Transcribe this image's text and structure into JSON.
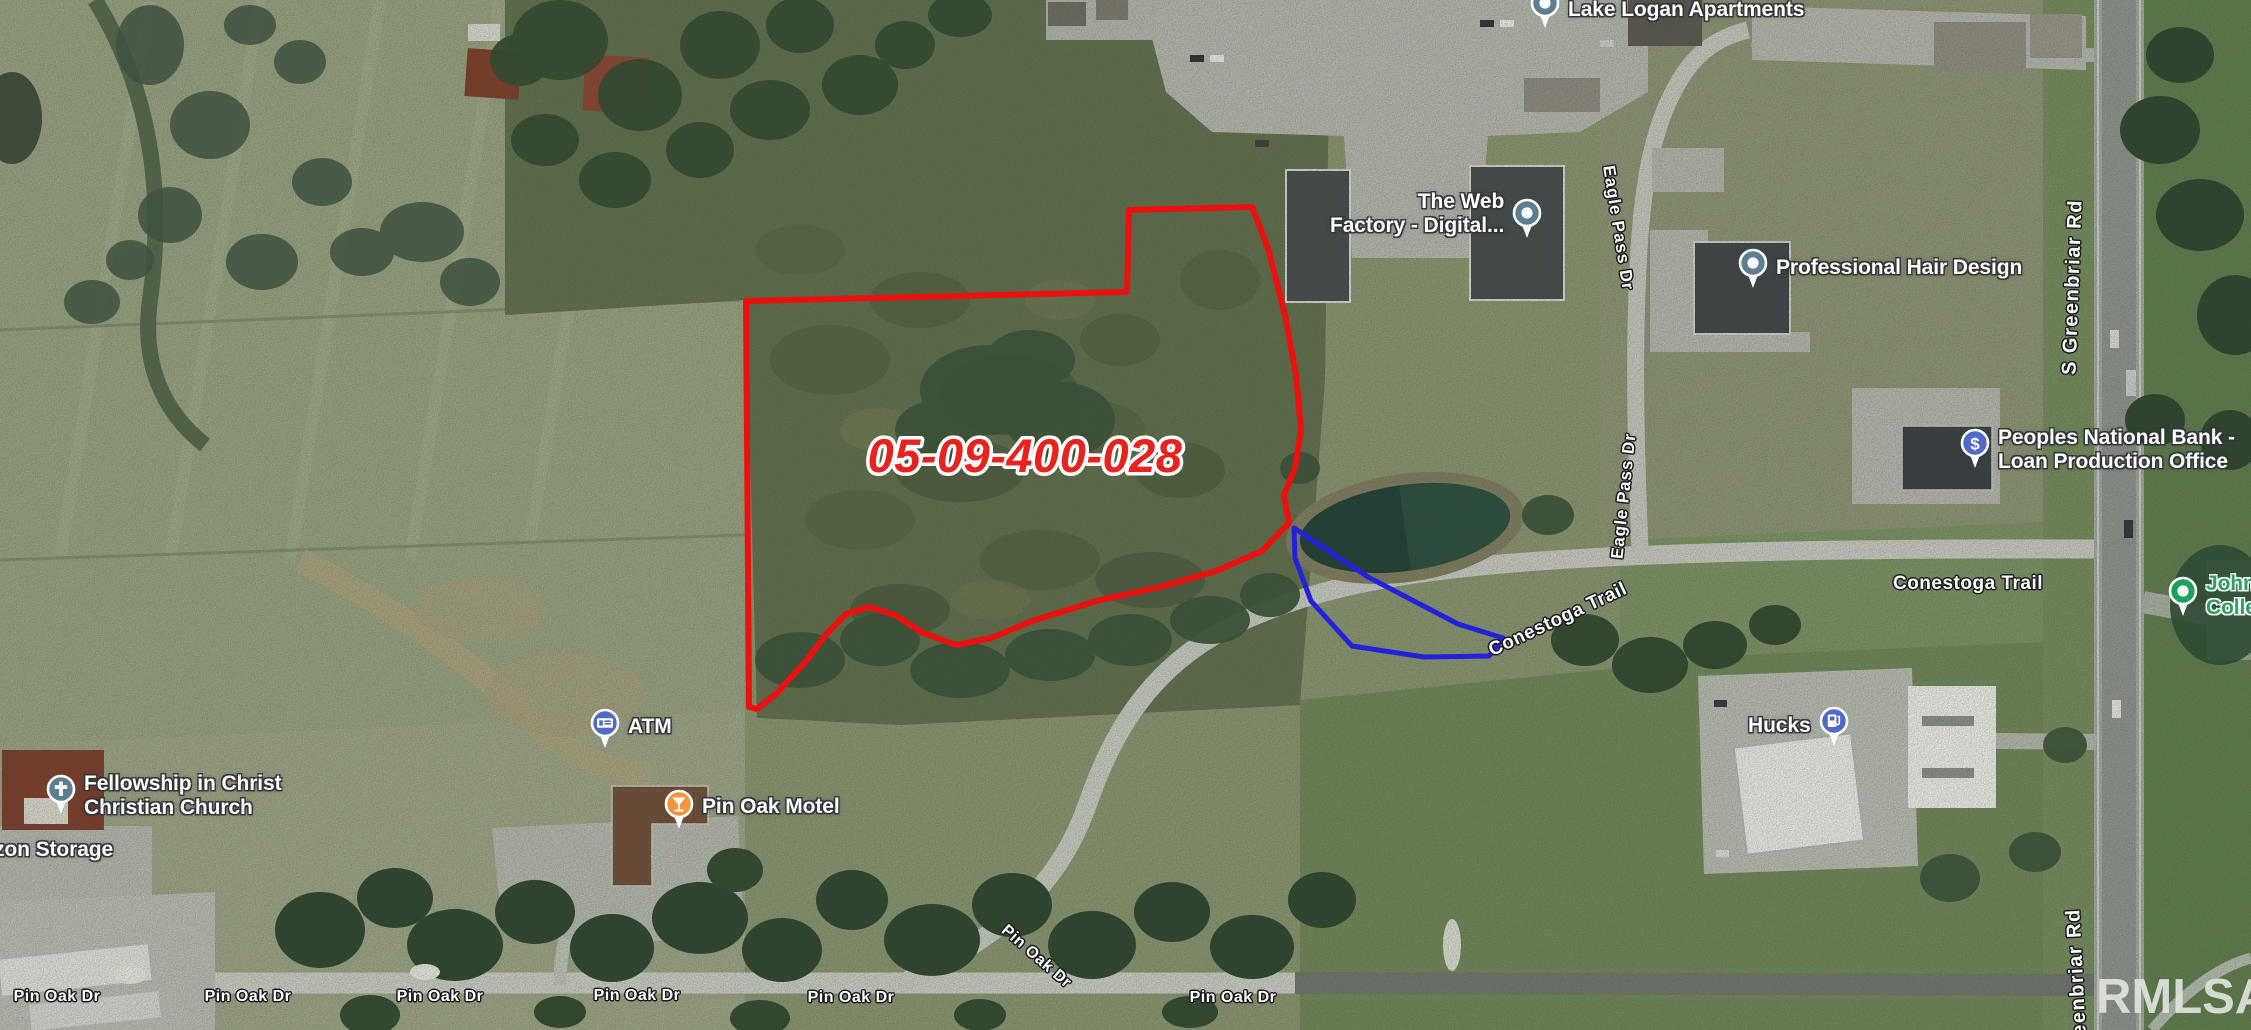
{
  "map": {
    "watermark": "RMLSA",
    "watermark_color": "rgba(223,227,221,0.92)",
    "parcel_label": {
      "text": "05-09-400-028",
      "fill": "#e8231e",
      "outline": "#ffffff"
    },
    "outlines": {
      "primary": {
        "name": "parcel-outline-red",
        "color": "#ec1111"
      },
      "secondary": {
        "name": "parcel-outline-blue",
        "color": "#2222dd"
      }
    }
  },
  "poi_labels": [
    {
      "id": "lake-logan-apartments",
      "lines": [
        "Lake Logan Apartments"
      ],
      "icon": "place-pin",
      "icon_color": "#5d7e90",
      "text_color": "#ffffff",
      "halo": "dark",
      "x": 1528,
      "y": -12,
      "pin_side": "left",
      "text_dy": 10,
      "pin_dy": 0,
      "align": "left"
    },
    {
      "id": "the-web-factory",
      "lines": [
        "The Web",
        "Factory - Digital..."
      ],
      "icon": "place-pin",
      "icon_color": "#5d7e90",
      "text_color": "#ffffff",
      "halo": "dark",
      "x": 1330,
      "y": 190,
      "pin_side": "right",
      "text_dy": 0,
      "pin_dy": 8,
      "align": "right"
    },
    {
      "id": "professional-hair-design",
      "lines": [
        "Professional Hair Design"
      ],
      "icon": "place-pin",
      "icon_color": "#5d7e90",
      "text_color": "#ffffff",
      "halo": "dark",
      "x": 1736,
      "y": 248,
      "pin_side": "left",
      "text_dy": 8,
      "pin_dy": 0,
      "align": "left"
    },
    {
      "id": "peoples-national-bank",
      "lines": [
        "Peoples National Bank -",
        "Loan Production Office"
      ],
      "icon": "dollar-pin",
      "icon_color": "#5169c7",
      "text_color": "#ffffff",
      "halo": "dark",
      "x": 1958,
      "y": 426,
      "pin_side": "left",
      "text_dy": 0,
      "pin_dy": 2,
      "align": "left"
    },
    {
      "id": "atm",
      "lines": [
        "ATM"
      ],
      "icon": "atm-pin",
      "icon_color": "#5169c7",
      "text_color": "#ffffff",
      "halo": "dark",
      "x": 588,
      "y": 708,
      "pin_side": "left",
      "text_dy": 7,
      "pin_dy": 0,
      "align": "left"
    },
    {
      "id": "pin-oak-motel",
      "lines": [
        "Pin Oak Motel"
      ],
      "icon": "martini-pin",
      "icon_color": "#f2953c",
      "text_color": "#ffffff",
      "halo": "dark",
      "x": 662,
      "y": 789,
      "pin_side": "left",
      "text_dy": 6,
      "pin_dy": 0,
      "align": "left"
    },
    {
      "id": "fellowship-church",
      "lines": [
        "Fellowship in Christ",
        "Christian Church"
      ],
      "icon": "cross-pin",
      "icon_color": "#5d7e90",
      "text_color": "#ffffff",
      "halo": "dark",
      "x": 44,
      "y": 772,
      "pin_side": "left",
      "text_dy": 0,
      "pin_dy": 2,
      "align": "left"
    },
    {
      "id": "storage",
      "lines": [
        "zon Storage"
      ],
      "icon": "none",
      "icon_color": "",
      "text_color": "#ffffff",
      "halo": "dark",
      "x": -6,
      "y": 838,
      "pin_side": "none",
      "text_dy": 0,
      "pin_dy": 0,
      "align": "left"
    },
    {
      "id": "hucks",
      "lines": [
        "Hucks"
      ],
      "icon": "gas-pin",
      "icon_color": "#5169c7",
      "text_color": "#ffffff",
      "halo": "dark",
      "x": 1748,
      "y": 706,
      "pin_side": "right",
      "text_dy": 8,
      "pin_dy": 0,
      "align": "left"
    },
    {
      "id": "john-a-logan-college",
      "lines": [
        "John",
        "Colle"
      ],
      "icon": "dot-pin",
      "icon_color": "#1da160",
      "text_color": "#2aa25e",
      "halo": "light",
      "x": 2166,
      "y": 574,
      "pin_side": "left",
      "text_dy": -2,
      "pin_dy": 2,
      "align": "left"
    }
  ],
  "road_labels": [
    {
      "id": "eagle-pass-dr-north",
      "text": "Eagle Pass Dr",
      "x": 1618,
      "y": 228,
      "rotate": 81,
      "size": 17,
      "ls": 1
    },
    {
      "id": "eagle-pass-dr-south",
      "text": "Eagle Pass Dr",
      "x": 1624,
      "y": 496,
      "rotate": -84,
      "size": 17,
      "ls": 1
    },
    {
      "id": "s-greenbriar-rd",
      "text": "S Greenbriar Rd",
      "x": 2073,
      "y": 287,
      "rotate": -88,
      "size": 20,
      "ls": 1.5
    },
    {
      "id": "greenbriar-rd-partial",
      "text": "eenbriar Rd",
      "x": 2077,
      "y": 972,
      "rotate": -93,
      "size": 20,
      "ls": 1.5
    },
    {
      "id": "conestoga-trail-west",
      "text": "Conestoga Trail",
      "x": 1558,
      "y": 620,
      "rotate": -25,
      "size": 19,
      "ls": 0.5
    },
    {
      "id": "conestoga-trail-east",
      "text": "Conestoga Trail",
      "x": 1968,
      "y": 584,
      "rotate": 0,
      "size": 19,
      "ls": 0.5
    },
    {
      "id": "pin-oak-dr-1",
      "text": "Pin Oak Dr",
      "x": 57,
      "y": 997,
      "rotate": 0,
      "size": 16,
      "ls": 0.5
    },
    {
      "id": "pin-oak-dr-2",
      "text": "Pin Oak Dr",
      "x": 248,
      "y": 997,
      "rotate": 0,
      "size": 16,
      "ls": 0.5
    },
    {
      "id": "pin-oak-dr-3",
      "text": "Pin Oak Dr",
      "x": 440,
      "y": 997,
      "rotate": 0,
      "size": 16,
      "ls": 0.5
    },
    {
      "id": "pin-oak-dr-4",
      "text": "Pin Oak Dr",
      "x": 637,
      "y": 996,
      "rotate": 0,
      "size": 16,
      "ls": 0.5
    },
    {
      "id": "pin-oak-dr-5",
      "text": "Pin Oak Dr",
      "x": 851,
      "y": 998,
      "rotate": 0,
      "size": 16,
      "ls": 0.5
    },
    {
      "id": "pin-oak-dr-6",
      "text": "Pin Oak Dr",
      "x": 1036,
      "y": 957,
      "rotate": 41,
      "size": 16,
      "ls": 0.5
    },
    {
      "id": "pin-oak-dr-7",
      "text": "Pin Oak Dr",
      "x": 1233,
      "y": 998,
      "rotate": 0,
      "size": 16,
      "ls": 0.5
    }
  ]
}
